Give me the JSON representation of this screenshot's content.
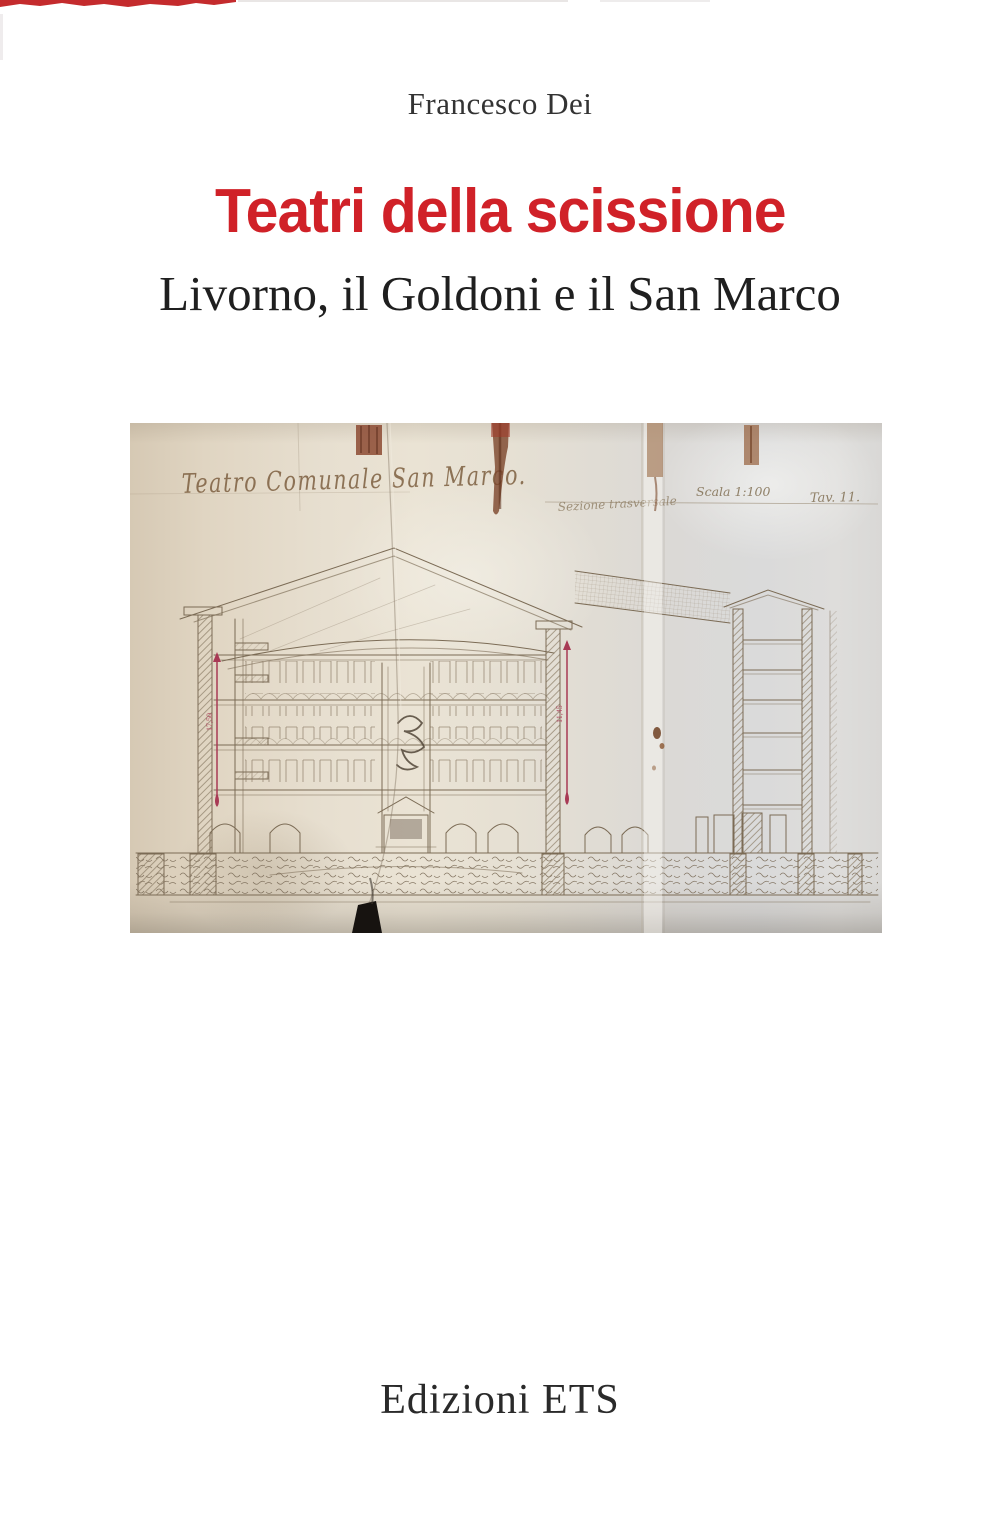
{
  "page": {
    "author": "Francesco Dei",
    "title": "Teatri della scissione",
    "subtitle": "Livorno, il Goldoni e il San Marco",
    "publisher": "Edizioni ETS"
  },
  "colors": {
    "title_red": "#d02128",
    "text_dark": "#1f1f1f",
    "top_strip_red": "#c42b2d",
    "paper_beige": "#e7dfd0",
    "ink_brown": "#7b6b55",
    "dimension_crimson": "#a83a55"
  },
  "drawing": {
    "handwritten_title": "Teatro Comunale San Marco.",
    "handwritten_note": "Sezione trasversale",
    "scale_label": "Scala 1:100",
    "plate_label": "Tav. 11.",
    "dim_left": "17,50",
    "dim_right": "11,45"
  }
}
